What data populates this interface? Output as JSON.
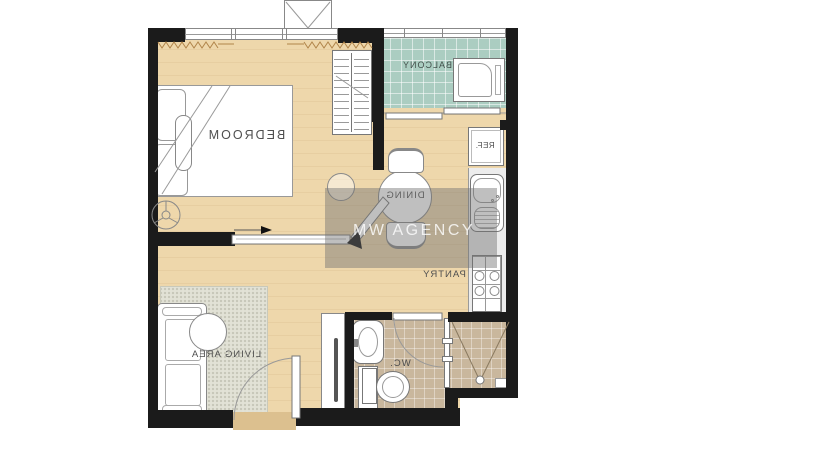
{
  "rooms": {
    "bedroom": "BEDROOM",
    "balcony": "BALCONY",
    "dining": "DINING",
    "pantry": "PANTRY",
    "living_area": "LIVING  AREA",
    "wc": "WC."
  },
  "appliances": {
    "refrigerator": "REF."
  },
  "watermark": {
    "text": "MW AGENCY"
  },
  "colors": {
    "wall": "#1b1b1b",
    "wood_floor": "#eed7ab",
    "balcony_tile": "#abcdc1",
    "bathroom_tile": "#c9b79d",
    "rug": "#e2e2d6",
    "counter": "#ececec",
    "threshold": "#dcc08f",
    "wm_band": "rgba(112,112,112,0.45)",
    "wm_text": "rgba(252,252,252,0.82)"
  }
}
